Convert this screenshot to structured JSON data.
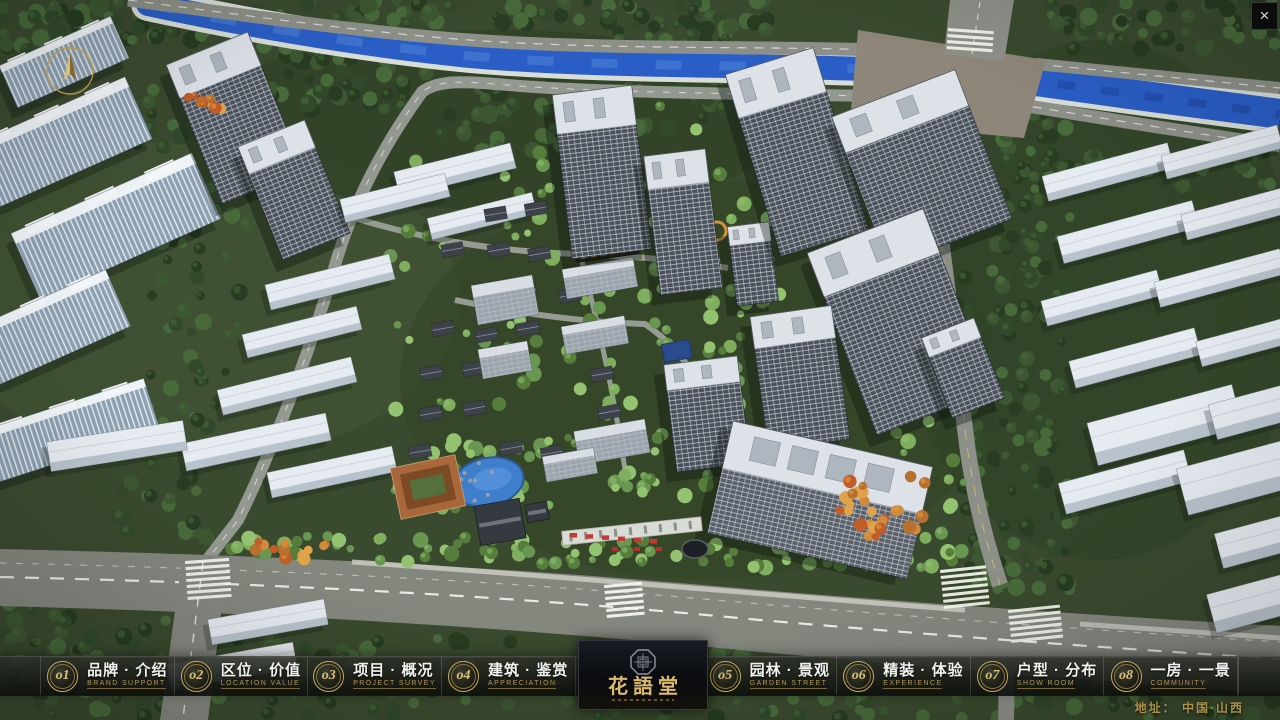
{
  "window": {
    "close_label": "×"
  },
  "logo": {
    "title": "花語堂"
  },
  "footer": {
    "address": "地址：  中国·山西"
  },
  "nav": {
    "items": [
      {
        "num": "o1",
        "label_cn": "品牌 · 介绍",
        "label_en": "BRAND SUPPORT"
      },
      {
        "num": "o2",
        "label_cn": "区位 · 价值",
        "label_en": "LOCATION VALUE"
      },
      {
        "num": "o3",
        "label_cn": "项目 · 概况",
        "label_en": "PROJECT SURVEY"
      },
      {
        "num": "o4",
        "label_cn": "建筑 · 鉴赏",
        "label_en": "APPRECIATION"
      },
      {
        "num": "o5",
        "label_cn": "园林 · 景观",
        "label_en": "GARDEN STREET"
      },
      {
        "num": "o6",
        "label_cn": "精装 · 体验",
        "label_en": "EXPERIENCE"
      },
      {
        "num": "o7",
        "label_cn": "户型 · 分布",
        "label_en": "SHOW ROOM"
      },
      {
        "num": "o8",
        "label_cn": "一房 · 一景",
        "label_en": "COMMUNITY"
      }
    ]
  },
  "scene_colors": {
    "tree_dark": "#31492a",
    "tree_bright": "#7fae5f",
    "river": "#2a5ec6",
    "road": "#84877e",
    "tower_wall": "#4a515b",
    "tower_roof": "#dce2e8",
    "accent_gold": "#d9ba6e",
    "accent_red": "#c23b32"
  }
}
